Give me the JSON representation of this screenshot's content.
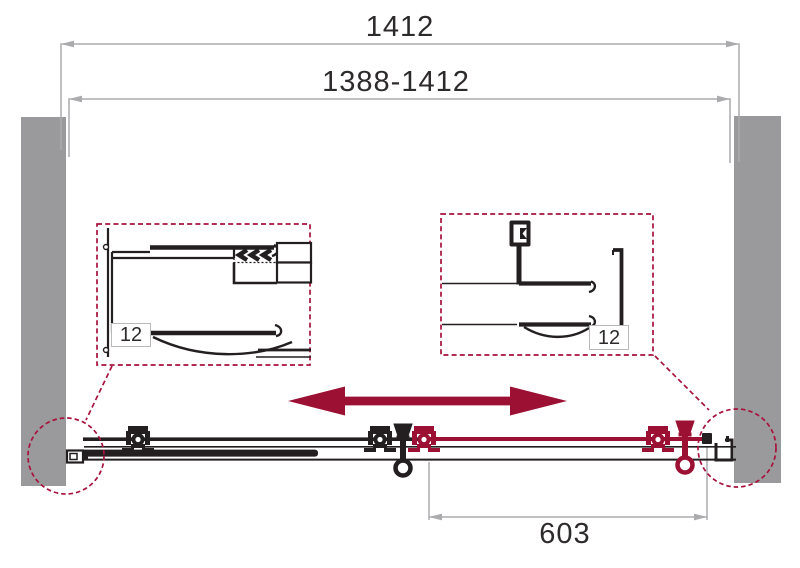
{
  "drawing": {
    "type": "technical-installation-diagram",
    "subject": "sliding shower door front view with profile detail callouts"
  },
  "colors": {
    "accent_red": "#9c1033",
    "dashed_red": "#a8123c",
    "wall_gray": "#9a9a9c",
    "dim_line_gray": "#ababad",
    "ink_black": "#231f20"
  },
  "dimensions": {
    "overall_width_mm": "1412",
    "adjustment_range_mm": "1388-1412",
    "sliding_door_width_mm": "603",
    "left_detail_adjustment_mm": "12",
    "right_detail_adjustment_mm": "12"
  }
}
